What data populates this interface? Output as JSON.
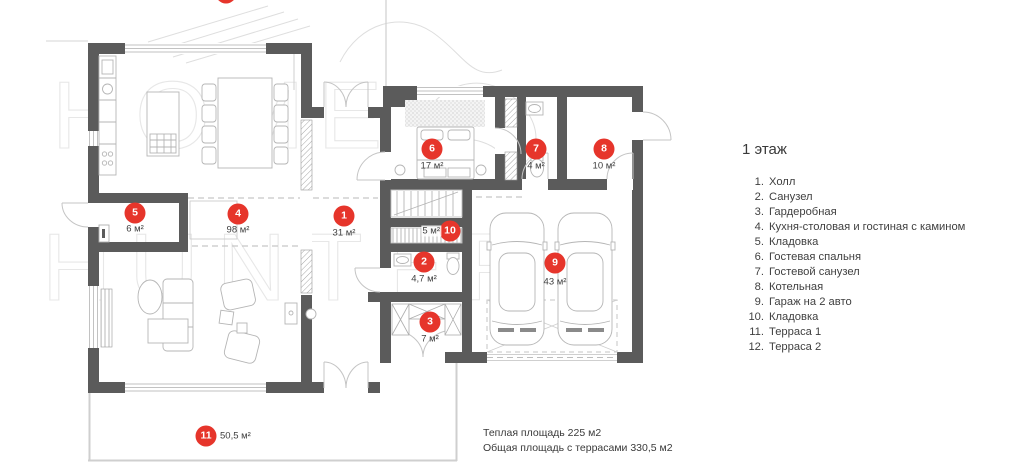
{
  "watermark": {
    "line1": "HOME",
    "line2": "HUNTER"
  },
  "plan": {
    "markers": [
      {
        "id": "1",
        "area": "31 м²"
      },
      {
        "id": "2",
        "area": "4,7 м²"
      },
      {
        "id": "3",
        "area": "7 м²"
      },
      {
        "id": "4",
        "area": "98 м²"
      },
      {
        "id": "5",
        "area": "6 м²"
      },
      {
        "id": "6",
        "area": "17 м²"
      },
      {
        "id": "7",
        "area": "4 м²"
      },
      {
        "id": "8",
        "area": "10 м²"
      },
      {
        "id": "9",
        "area": "43 м²"
      },
      {
        "id": "10",
        "area": "5 м²"
      },
      {
        "id": "11",
        "area": "50,5 м²"
      },
      {
        "id": "12",
        "area": ""
      }
    ]
  },
  "legend": {
    "title": "1 этаж",
    "items": [
      {
        "num": "1.",
        "label": "Холл"
      },
      {
        "num": "2.",
        "label": "Санузел"
      },
      {
        "num": "3.",
        "label": "Гардеробная"
      },
      {
        "num": "4.",
        "label": "Кухня-столовая и гостиная с камином"
      },
      {
        "num": "5.",
        "label": "Кладовка"
      },
      {
        "num": "6.",
        "label": "Гостевая спальня"
      },
      {
        "num": "7.",
        "label": "Гостевой санузел"
      },
      {
        "num": "8.",
        "label": "Котельная"
      },
      {
        "num": "9.",
        "label": "Гараж на 2 авто"
      },
      {
        "num": "10.",
        "label": "Кладовка"
      },
      {
        "num": "11.",
        "label": "Терраса 1"
      },
      {
        "num": "12.",
        "label": "Терраса 2"
      }
    ]
  },
  "footer": {
    "line1": "Теплая площадь 225 м2",
    "line2": "Общая площадь с террасами 330,5 м2"
  },
  "colors": {
    "wall": "#5b5b5b",
    "marker_red": "#e6352b",
    "line_light": "#c9c9c9"
  }
}
